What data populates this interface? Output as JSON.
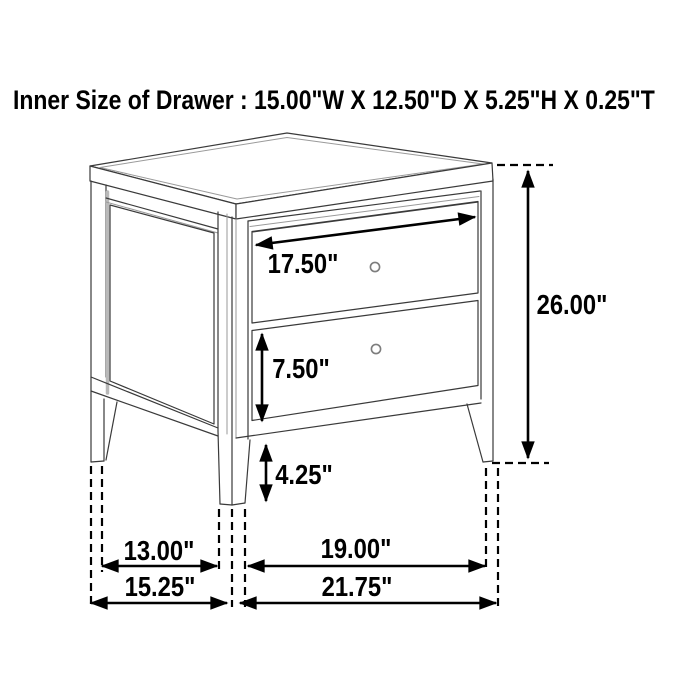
{
  "page": {
    "title": "Inner Size of Drawer : 15.00\"W X 12.50\"D X 5.25\"H X 0.25\"T"
  },
  "subject": "2-drawer nightstand line drawing with dimension arrows",
  "dimensions": {
    "drawer_face_width": "17.50\"",
    "overall_height": "26.00\"",
    "drawer_face_height": "7.50\"",
    "floor_to_rail_height": "4.25\"",
    "side_inner_leg_span": "13.00\"",
    "front_inner_leg_span": "19.00\"",
    "overall_depth": "15.25\"",
    "overall_width": "21.75\""
  },
  "colors": {
    "background": "#ffffff",
    "drawing_line": "#3a3a3a",
    "dimension_line": "#000000",
    "text": "#000000"
  }
}
